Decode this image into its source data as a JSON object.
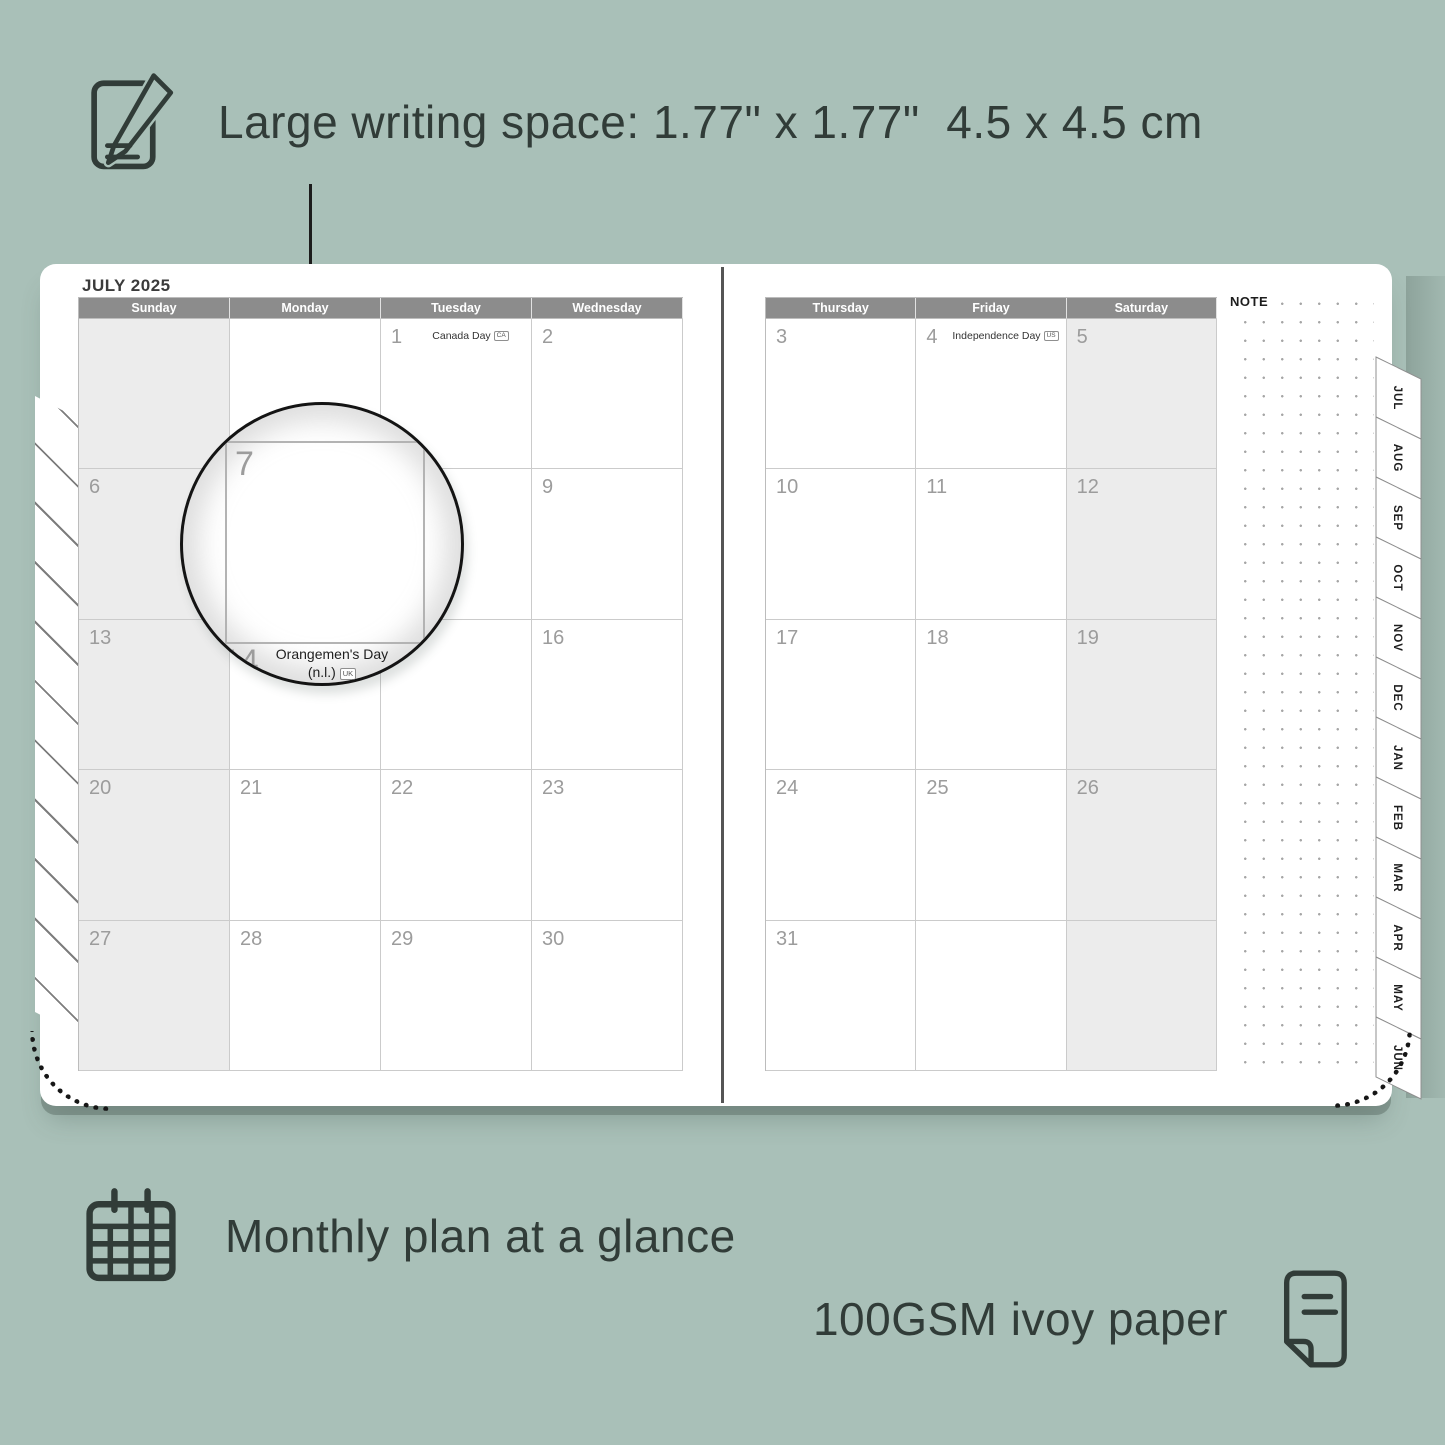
{
  "colors": {
    "background": "#a9c0b8",
    "ink": "#313c38",
    "header_bar": "#8c8c8c",
    "weekend_shade": "#ececec",
    "grid_line": "#cbcbcb",
    "date_number": "#9c9c9c"
  },
  "annotations": {
    "writing_space": "Large writing space: 1.77\" x 1.77\"  4.5 x 4.5 cm",
    "monthly_plan": "Monthly plan at a glance",
    "paper": "100GSM ivoy paper"
  },
  "planner": {
    "title": "JULY 2025",
    "note_label": "NOTE",
    "tabs": [
      "JUL",
      "AUG",
      "SEP",
      "OCT",
      "NOV",
      "DEC",
      "JAN",
      "FEB",
      "MAR",
      "APR",
      "MAY",
      "JUN"
    ],
    "left_page": {
      "headers": [
        "Sunday",
        "Monday",
        "Tuesday",
        "Wednesday"
      ],
      "shaded_column": 0,
      "weeks": [
        [
          {
            "day": ""
          },
          {
            "day": ""
          },
          {
            "day": "1",
            "holiday": "Canada Day",
            "badge": "CA"
          },
          {
            "day": "2"
          }
        ],
        [
          {
            "day": "6"
          },
          {
            "day": "7"
          },
          {
            "day": "8"
          },
          {
            "day": "9"
          }
        ],
        [
          {
            "day": "13"
          },
          {
            "day": "14",
            "holiday": "Orangemen's Day (n.l.)",
            "badge": "UK"
          },
          {
            "day": "15"
          },
          {
            "day": "16"
          }
        ],
        [
          {
            "day": "20"
          },
          {
            "day": "21"
          },
          {
            "day": "22"
          },
          {
            "day": "23"
          }
        ],
        [
          {
            "day": "27"
          },
          {
            "day": "28"
          },
          {
            "day": "29"
          },
          {
            "day": "30"
          }
        ]
      ]
    },
    "right_page": {
      "headers": [
        "Thursday",
        "Friday",
        "Saturday"
      ],
      "shaded_column": 2,
      "weeks": [
        [
          {
            "day": "3"
          },
          {
            "day": "4",
            "holiday": "Independence Day",
            "badge": "US"
          },
          {
            "day": "5"
          }
        ],
        [
          {
            "day": "10"
          },
          {
            "day": "11"
          },
          {
            "day": "12"
          }
        ],
        [
          {
            "day": "17"
          },
          {
            "day": "18"
          },
          {
            "day": "19"
          }
        ],
        [
          {
            "day": "24"
          },
          {
            "day": "25"
          },
          {
            "day": "26"
          }
        ],
        [
          {
            "day": "31"
          },
          {
            "day": ""
          },
          {
            "day": ""
          }
        ]
      ]
    },
    "magnifier": {
      "day": "7",
      "next_day": "14",
      "holiday_line1": "Orangemen's Day",
      "holiday_line2": "(n.l.)",
      "badge": "UK"
    }
  }
}
